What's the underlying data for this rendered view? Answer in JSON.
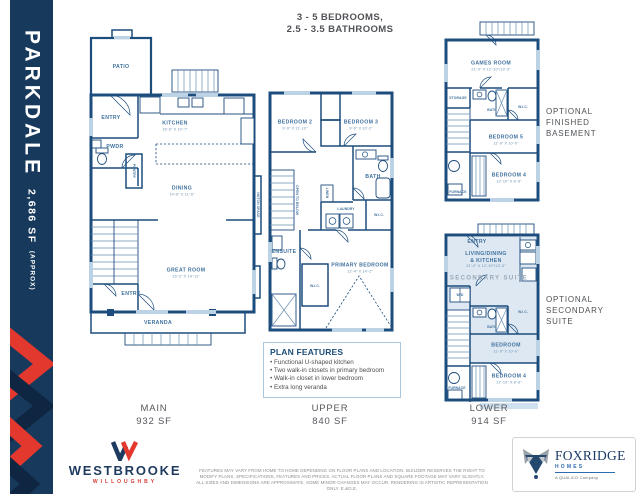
{
  "colors": {
    "navy": "#17395c",
    "wall_blue": "#1d4d7c",
    "label_blue": "#41729f",
    "accent_red": "#e2382e",
    "light_blue": "#bcd3e6",
    "suite_shade": "#dde8f3",
    "text_gray": "#55585c"
  },
  "sidebar": {
    "title": "PARKDALE",
    "area": "2,686 SF",
    "area_suffix": "(APPROX)"
  },
  "header": {
    "line1": "3 - 5 BEDROOMS,",
    "line2": "2.5 - 3.5 BATHROOMS"
  },
  "floors": {
    "main": {
      "label": "MAIN",
      "area": "932 SF"
    },
    "upper": {
      "label": "UPPER",
      "area": "840 SF"
    },
    "lower": {
      "label": "LOWER",
      "area": "914 SF"
    }
  },
  "main_plan": {
    "patio": "PATIO",
    "entry": "ENTRY",
    "kitchen": "KITCHEN",
    "kitchen_dims": "16'-6\" X 10'-7\"",
    "pwdr": "PWDR",
    "pantry": "PANTRY",
    "dining": "DINING",
    "dining_dims": "14'-6\" X 11'-6\"",
    "hutch": "HUTCH SPACE",
    "great_room": "GREAT ROOM",
    "great_room_dims": "16'-2\" X 14'-11\"",
    "entry2": "ENTRY",
    "veranda": "VERANDA"
  },
  "upper_plan": {
    "bedroom2": "BEDROOM 2",
    "bedroom2_dims": "9'-9\" X 11'-10\"",
    "bedroom3": "BEDROOM 3",
    "bedroom3_dims": "9'-9\" X 10'-2\"",
    "bath": "BATH",
    "laundry": "LAUNDRY",
    "linen": "LINEN",
    "wic": "W.I.C.",
    "open_below": "OPEN TO BELOW",
    "ensuite": "ENSUITE",
    "wic2": "W.I.C.",
    "primary": "PRIMARY BEDROOM",
    "primary_dims": "12'-4\" X 14'-2\""
  },
  "basement_plan": {
    "side_label_1": "OPTIONAL",
    "side_label_2": "FINISHED",
    "side_label_3": "BASEMENT",
    "games_room": "GAMES ROOM",
    "games_room_dims": "21'-0\" X 12'-10\"/13'-3\"",
    "storage": "STORAGE",
    "bath": "BATH",
    "wic": "W.I.C.",
    "bedroom5": "BEDROOM 5",
    "bedroom5_dims": "11'-9\" X 10'-0\"",
    "bedroom4": "BEDROOM 4",
    "bedroom4_dims": "12'-10\" X 8'-6\"",
    "furnace": "FURNACE"
  },
  "suite_plan": {
    "side_label_1": "OPTIONAL",
    "side_label_2": "SECONDARY",
    "side_label_3": "SUITE",
    "entry": "ENTRY",
    "living_1": "LIVING/DINING",
    "living_2": "& KITCHEN",
    "living_dims": "21'-0\" X 12'-10\"/13'-3\"",
    "suite_banner": "SECONDARY SUITE",
    "wd": "W/D",
    "bath": "BATH",
    "wic": "W.I.C.",
    "bedroom": "BEDROOM",
    "bedroom_dims": "11'-9\" X 10'-0\"",
    "bedroom4": "BEDROOM 4",
    "bedroom4_dims": "12'-10\" X 8'-6\"",
    "furnace": "FURNACE"
  },
  "features": {
    "title": "PLAN FEATURES",
    "items": [
      "Functional U-shaped kitchen",
      "Two walk-in closets in primary bedroom",
      "Walk-in closet in lower bedroom",
      "Extra long veranda"
    ]
  },
  "footer": {
    "westbrooke": "WESTBROOKE",
    "willoughby": "WILLOUGHBY",
    "disclaimer": "FEATURES MAY VARY FROM HOME TO HOME DEPENDING ON FLOOR PLANS AND LOCATION. BUILDER RESERVES THE RIGHT TO MODIFY PLANS, SPECIFICATIONS, FEATURES AND PRICES. ACTUAL FLOOR PLANS AND SQUARE FOOTAGE MAY VARY SLIGHTLY. ALL SIZES AND DIMENSIONS ARE APPROXIMATE. SOME MINOR CHANGES MAY OCCUR. RENDERING IS ARTISTIC REPRESENTATION ONLY. E.&O.E.",
    "foxridge": "FOXRIDGE",
    "homes": "HOMES",
    "qualico": "A QUALICO Company"
  }
}
